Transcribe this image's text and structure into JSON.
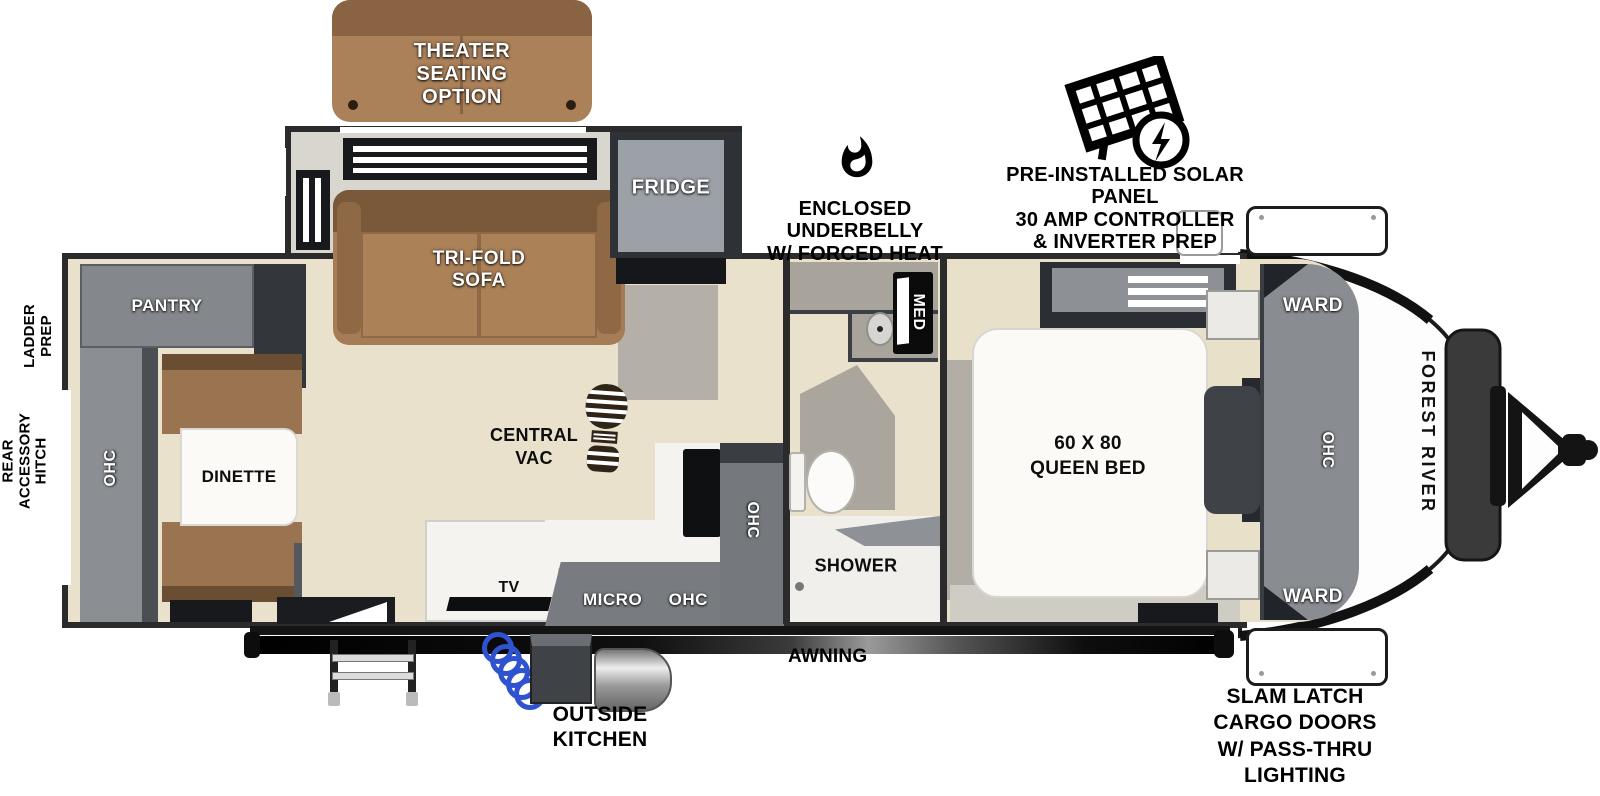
{
  "labels": {
    "theater_option": [
      "THEATER",
      "SEATING",
      "OPTION"
    ],
    "fridge": "FRIDGE",
    "tri_fold_sofa": [
      "TRI-FOLD",
      "SOFA"
    ],
    "pantry": "PANTRY",
    "rear_ohc": "OHC",
    "dinette": "DINETTE",
    "central_vac": [
      "CENTRAL",
      "VAC"
    ],
    "tv": "TV",
    "micro": "MICRO",
    "kitchen_ohc_lower": "OHC",
    "kitchen_ohc_upper": "OHC",
    "shower": "SHOWER",
    "med_cabinet": "MED",
    "queen_bed": [
      "60 X 80",
      "QUEEN BED"
    ],
    "ward_top": "WARD",
    "ward_bottom": "WARD",
    "bedroom_ohc": "OHC",
    "brand": "FOREST RIVER",
    "awning": "AWNING",
    "outside_kitchen": [
      "OUTSIDE",
      "KITCHEN"
    ],
    "slam_latch": [
      "SLAM LATCH",
      "CARGO DOORS",
      "W/ PASS-THRU",
      "LIGHTING"
    ],
    "enclosed_underbelly": [
      "ENCLOSED UNDERBELLY",
      "W/ FORCED HEAT"
    ],
    "solar": [
      "PRE-INSTALLED SOLAR PANEL",
      "30 AMP CONTROLLER",
      "& INVERTER PREP"
    ],
    "ladder_prep": [
      "LADDER",
      "PREP"
    ],
    "rear_hitch": [
      "REAR",
      "ACCESSORY",
      "HITCH"
    ]
  },
  "icons": {
    "flame": "flame-icon",
    "solar_panel": "solar-panel-icon",
    "boot_print": "boot-print-icon"
  },
  "colors": {
    "wall": "#2b2b2b",
    "floor_wood": "#e8e0c9",
    "floor_gray": "#b2aea5",
    "cabinet_gray": "#85898e",
    "sofa_brown": "#a57c55",
    "bench_brown": "#9a7350",
    "fridge_gray": "#9ba1a7",
    "hose_blue": "#2f52cf",
    "label_white": "#ffffff",
    "label_black": "#111111"
  }
}
